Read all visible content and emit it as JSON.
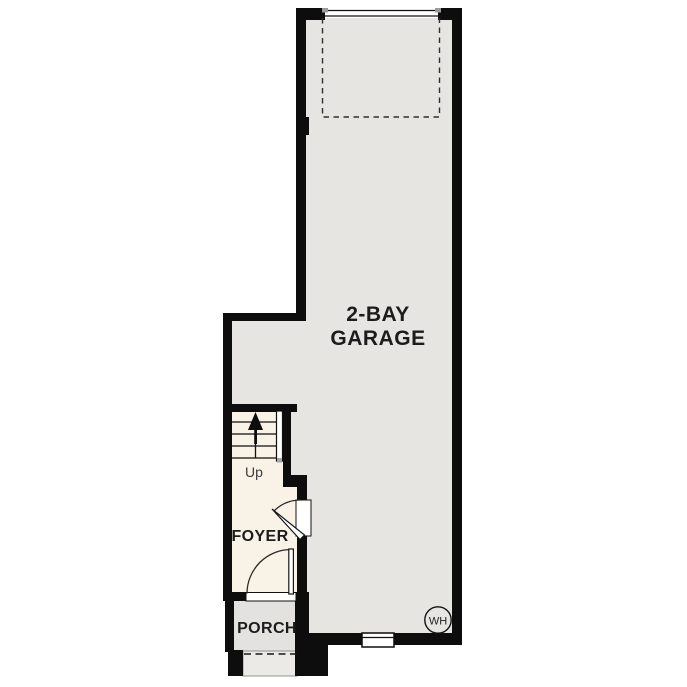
{
  "page": {
    "background": "#ffffff"
  },
  "floor_plan": {
    "rooms": {
      "garage": {
        "label_line1": "2-BAY",
        "label_line2": "GARAGE"
      },
      "foyer": {
        "label": "FOYER"
      },
      "porch": {
        "label": "PORCH"
      }
    },
    "stairs": {
      "direction_label": "Up"
    },
    "water_heater": {
      "label": "WH"
    },
    "colors": {
      "garage_floor": "#e6e5e2",
      "interior_floor": "#f9f2e6",
      "porch_floor": "#e3e2df",
      "step_floor": "#ebeae7",
      "wall": "#0d0d0d",
      "label_text": "#1c1c1c",
      "secondary_text": "#3c3c3c"
    }
  }
}
